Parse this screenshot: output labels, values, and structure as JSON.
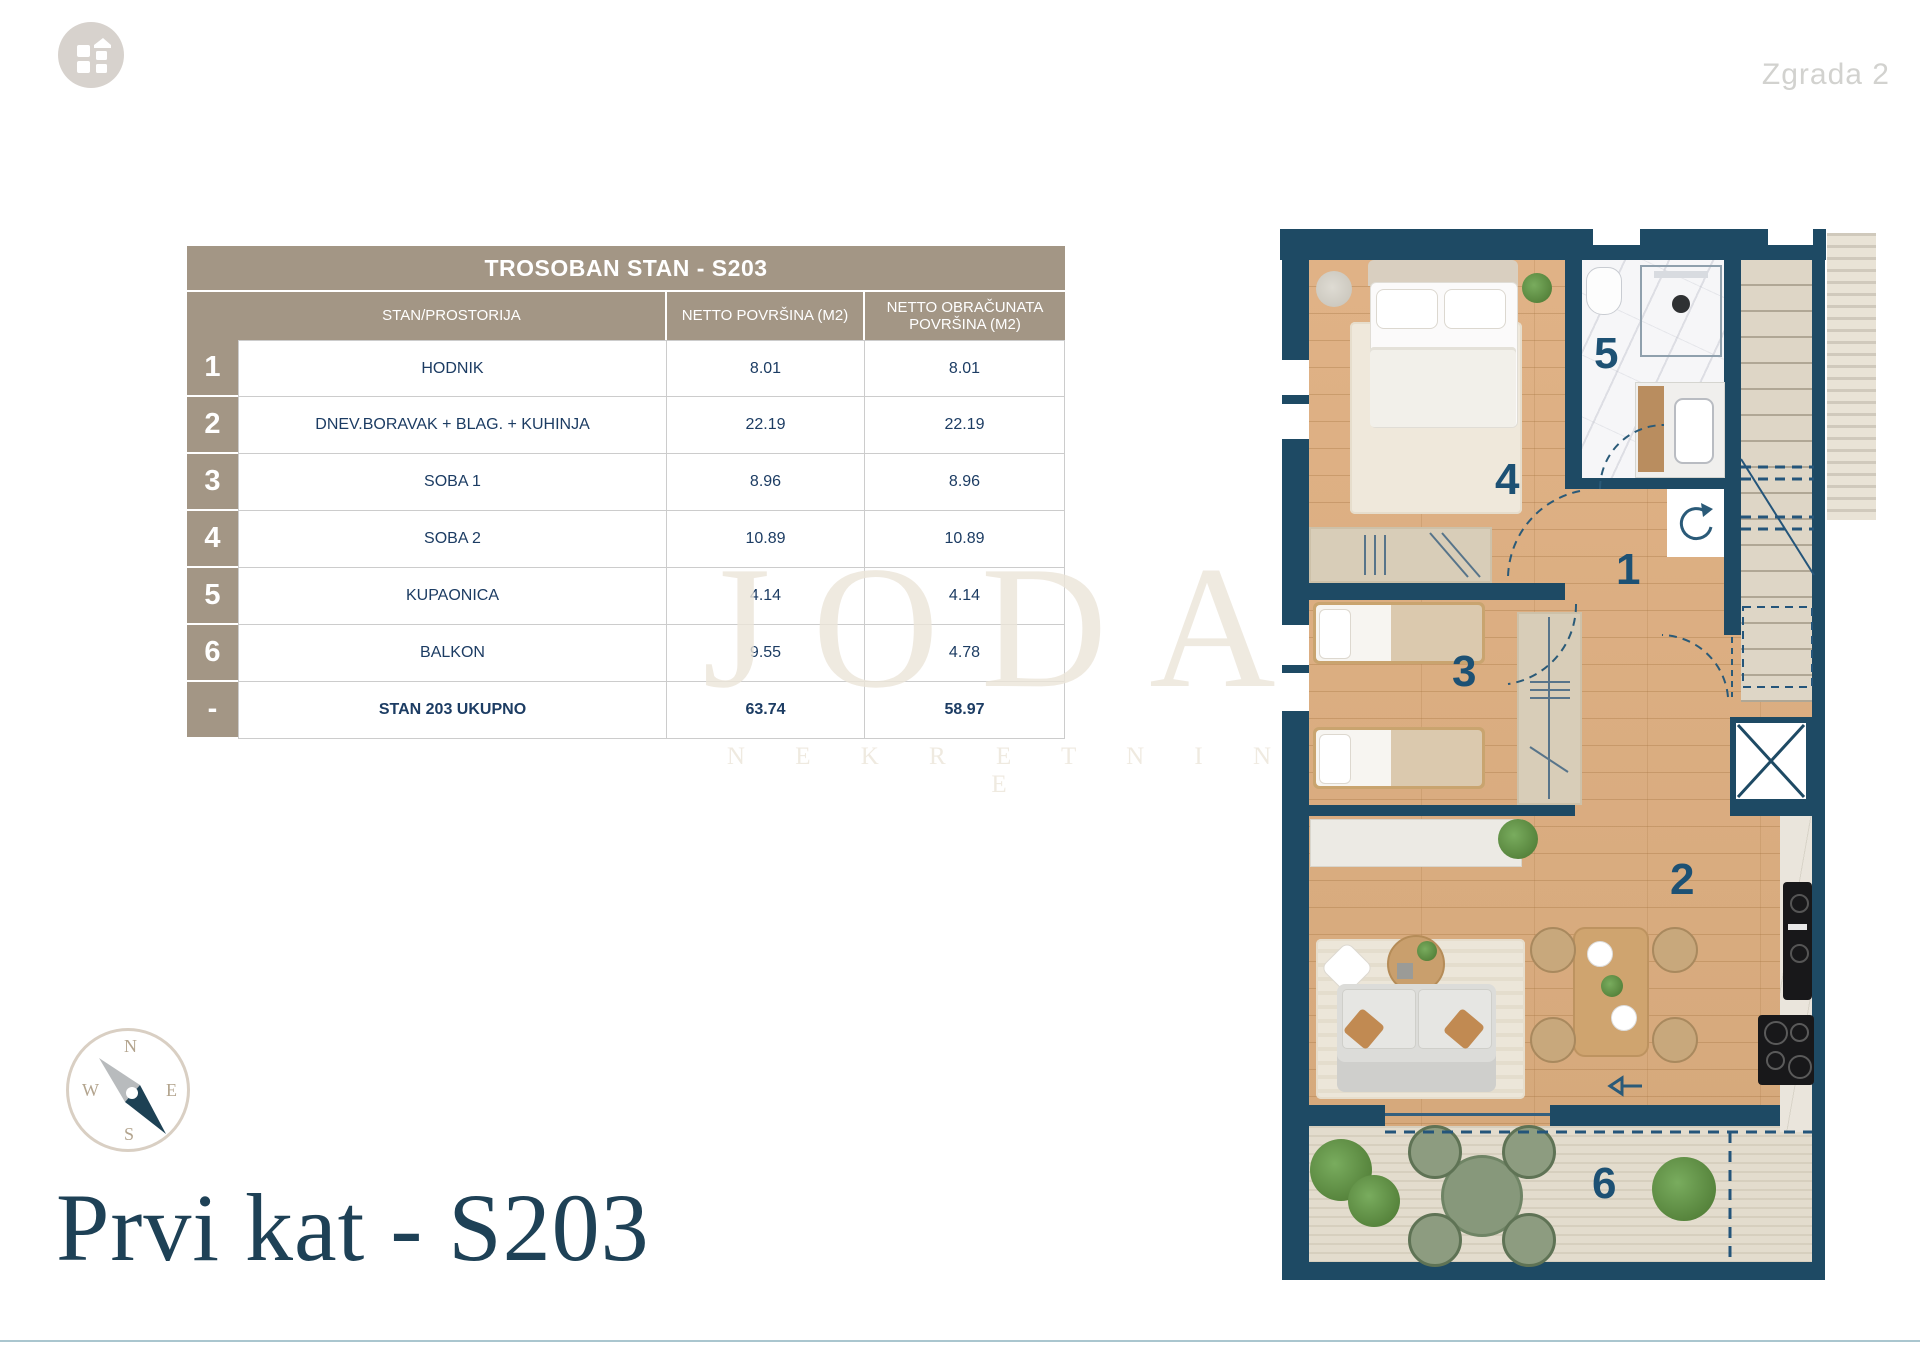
{
  "page": {
    "building_label": "Zgrada 2",
    "floor_title": "Prvi kat - S203"
  },
  "watermark": {
    "brand": "JODA",
    "subtitle": "N E K R E T N I N E"
  },
  "compass": {
    "north": "N",
    "east": "E",
    "south": "S",
    "west": "W"
  },
  "table": {
    "title": "TROSOBAN STAN - S203",
    "col_room": "STAN/PROSTORIJA",
    "col_net": "NETTO POVRŠINA (M2)",
    "col_calc": "NETTO OBRAČUNATA POVRŠINA (M2)",
    "rows": [
      {
        "num": "1",
        "name": "HODNIK",
        "net": "8.01",
        "calc": "8.01"
      },
      {
        "num": "2",
        "name": "DNEV.BORAVAK + BLAG. + KUHINJA",
        "net": "22.19",
        "calc": "22.19"
      },
      {
        "num": "3",
        "name": "SOBA 1",
        "net": "8.96",
        "calc": "8.96"
      },
      {
        "num": "4",
        "name": "SOBA 2",
        "net": "10.89",
        "calc": "10.89"
      },
      {
        "num": "5",
        "name": "KUPAONICA",
        "net": "4.14",
        "calc": "4.14"
      },
      {
        "num": "6",
        "name": "BALKON",
        "net": "9.55",
        "calc": "4.78"
      },
      {
        "num": "-",
        "name": "STAN 203 UKUPNO",
        "net": "63.74",
        "calc": "58.97"
      }
    ]
  },
  "plan": {
    "labels": {
      "hallway": "1",
      "living": "2",
      "bedroom1": "3",
      "bedroom2": "4",
      "bathroom": "5",
      "balcony": "6"
    }
  },
  "colors": {
    "wall_navy": "#1e4a64",
    "taupe": "#a39685",
    "accent_navy": "#1d5174",
    "text_navy": "#1c3c63"
  }
}
